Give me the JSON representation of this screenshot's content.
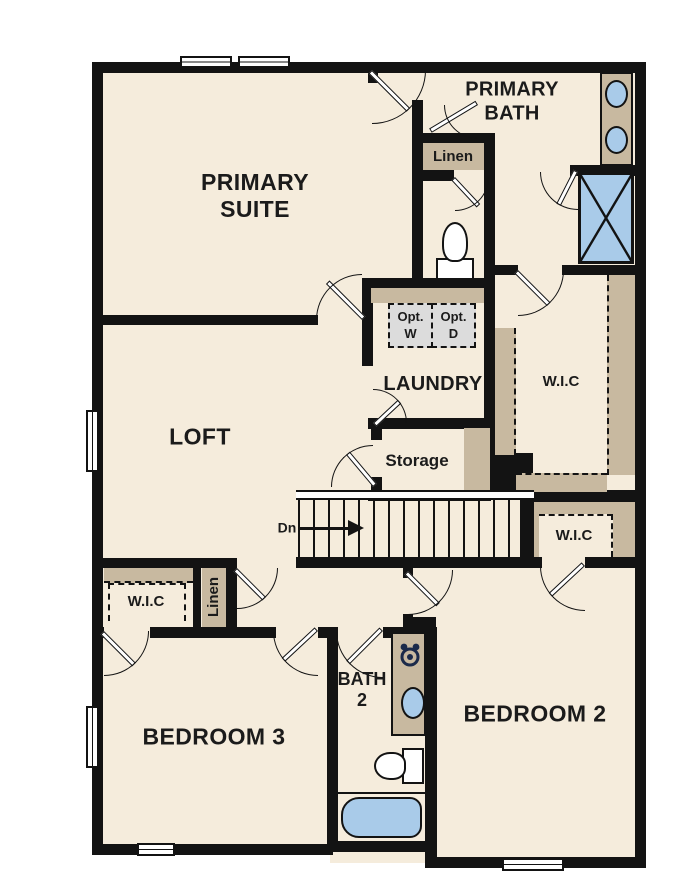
{
  "title": "Second Floor Plan",
  "colors": {
    "background": "#ffffff",
    "wall": "#131313",
    "floor": "#f5ecdc",
    "casework": "#c8b9a0",
    "fixture": "#a9cbe9",
    "appliance": "#dcdcdc"
  },
  "rooms": {
    "primary_suite": {
      "line1": "PRIMARY",
      "line2": "SUITE"
    },
    "primary_bath": {
      "line1": "PRIMARY",
      "line2": "BATH"
    },
    "loft": {
      "label": "LOFT"
    },
    "laundry": {
      "label": "LAUNDRY"
    },
    "storage": {
      "label": "Storage"
    },
    "bath2": {
      "line1": "BATH",
      "line2": "2"
    },
    "bedroom2": {
      "label": "BEDROOM 2"
    },
    "bedroom3": {
      "label": "BEDROOM 3"
    },
    "wic_right_large": {
      "label": "W.I.C"
    },
    "wic_right_small": {
      "label": "W.I.C"
    },
    "wic_left": {
      "label": "W.I.C"
    }
  },
  "closets": {
    "linen_top": "Linen",
    "linen_left": "Linen"
  },
  "appliances": {
    "washer": {
      "line1": "Opt.",
      "line2": "W"
    },
    "dryer": {
      "line1": "Opt.",
      "line2": "D"
    }
  },
  "stairs": {
    "direction_label": "Dn"
  }
}
